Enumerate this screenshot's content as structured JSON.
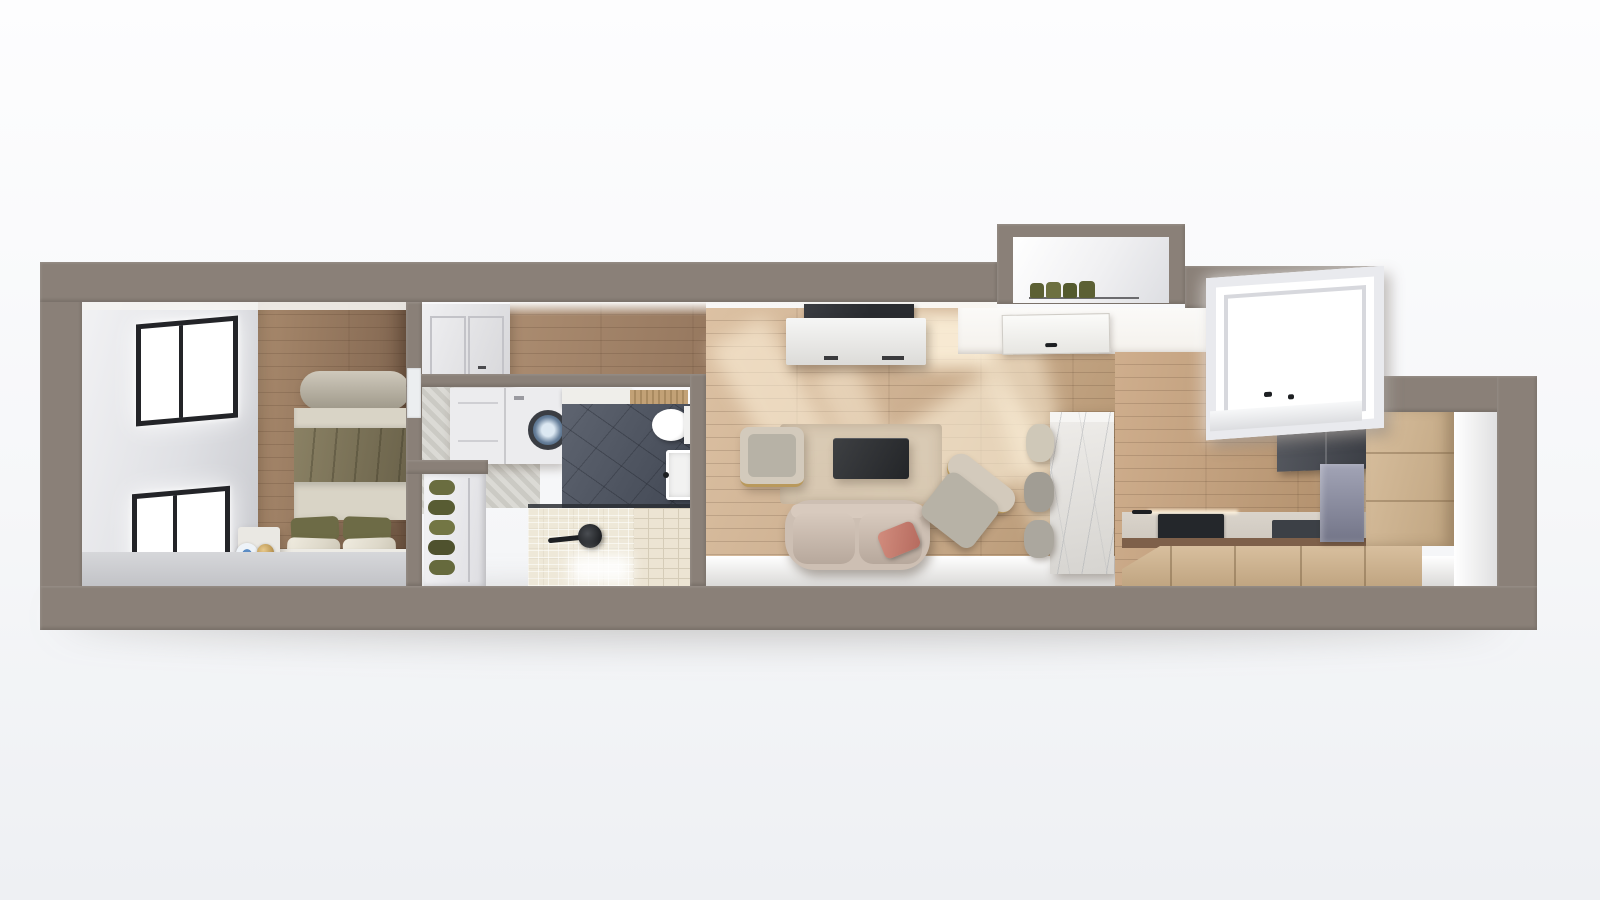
{
  "scene": {
    "label": "3d-cutaway-floor-plan-render-of-narrow-studio-apartment",
    "rooms": [
      {
        "name": "bedroom",
        "objects": [
          "window",
          "window",
          "double-bed",
          "olive-duvet",
          "pillows",
          "foot-bolster",
          "headboard-bench",
          "green-bench-cushions",
          "nightstand",
          "table-lamp",
          "decor-plate",
          "wood-floor"
        ]
      },
      {
        "name": "hallway",
        "objects": [
          "wardrobe",
          "wood-floor"
        ]
      },
      {
        "name": "bathroom",
        "objects": [
          "washer-dryer",
          "herringbone-tile",
          "patterned-dark-tile-floor",
          "toilet",
          "sink",
          "glass-shower-screen",
          "shower-head",
          "cream-tile-shower-floor",
          "towel-shelves"
        ]
      },
      {
        "name": "living-room",
        "objects": [
          "tv",
          "tv-console",
          "rug",
          "coffee-table",
          "armchair",
          "angled-armchair",
          "two-seat-sofa",
          "pink-pillow",
          "sunlight-patches",
          "wood-floor"
        ]
      },
      {
        "name": "entry",
        "objects": [
          "front-door",
          "plant-niche",
          "plants"
        ]
      },
      {
        "name": "kitchen",
        "objects": [
          "large-window",
          "marble-island",
          "bar-stools",
          "beige-base-cabinets",
          "tall-beige-cabinet",
          "dark-upper-unit",
          "marble-chimney-panel",
          "cooktop",
          "counter-sink",
          "faucet",
          "wood-floor"
        ]
      }
    ]
  },
  "palette": {
    "bg_top": "#fdfdfe",
    "bg_bottom": "#eef0f3",
    "wall": "#8a8078",
    "ceiling_white": "#f4f3f0",
    "bed_wall1": "#f2f2f4",
    "bed_wall2": "#c6c7cc",
    "wood_bed1": "#a8896c",
    "wood_bed2": "#7e634e",
    "wood_hall1": "#ab8c70",
    "wood_hall2": "#96785f",
    "wood_liv1": "#dcc1a3",
    "wood_liv2": "#b3936f",
    "wood_kit1": "#cfae8d",
    "wood_kit2": "#ac8a66",
    "sunlight": "#fff4de",
    "window_frame": "#232428",
    "glass": "#ffffff",
    "bolster1": "#cfc9bc",
    "bolster2": "#9e9889",
    "duvet1": "#8a8164",
    "duvet2": "#6a624a",
    "bed_band": "#d9d4c6",
    "pillow_dark": "#6d6b46",
    "pillow_light": "#ddd8c9",
    "bench_white": "#edebe5",
    "bench_cushion": "#575a33",
    "nightstand": "#eae8e3",
    "lamp_gold": "#bf9b58",
    "plate_blue": "#5b8cc4",
    "wardrobe1": "#f0f0f2",
    "wardrobe2": "#d7d7da",
    "washer": "#ececee",
    "washer_ring": "#3a3d43",
    "washer_glass": "#68809b",
    "chevron1": "#dbdad5",
    "chevron2": "#cbcac4",
    "slat_wood": "#c2a176",
    "dark_tile1": "#5e6470",
    "dark_tile2": "#424854",
    "cream_tile": "#ece4d3",
    "cream_grout": "#d5ccb8",
    "towel_green": "#6a6d40",
    "bath_shelf": "#efeeea",
    "glass_screen": "#2c2f35",
    "fixture_black": "#1d1f22",
    "console1": "#f6f6f5",
    "console2": "#dcdbd8",
    "tv_black": "#2a2c30",
    "rug": "#d9cab4",
    "chair_body": "#d3cabc",
    "chair_seat": "#b7b2a6",
    "gold_trim": "#b9995c",
    "table1": "#3e4043",
    "table2": "#232528",
    "sofa_body": "#cdbfb3",
    "sofa_cushion": "#b7a89c",
    "sofa_light": "#d8cabe",
    "pink1": "#d28d7e",
    "pink2": "#b56a5e",
    "marble1": "#efedea",
    "marble2": "#d6d4d0",
    "marble_vein": "#a7abb0",
    "stool1": "#cfc8b8",
    "stool2": "#a19d94",
    "stool3": "#aba79e",
    "entry_white": "#f4f1ec",
    "door_white": "#fbfbf9",
    "plant_green": "#5c6034",
    "cab_beige1": "#d8bf9e",
    "cab_beige2": "#bfa480",
    "dark_unit1": "#565960",
    "dark_unit2": "#393c43",
    "chimney1": "#a2a4b6",
    "chimney2": "#737588",
    "counter_grey": "#cfc9c0",
    "counter_edge": "#7e604a",
    "cooktop": "#24272b",
    "right_face1": "#ffffff",
    "right_face2": "#dfdfe0",
    "band1": "#ffffff",
    "band2": "#d8d7d5",
    "bedroom_band1": "#d6d7da",
    "bedroom_band2": "#c2c3c7"
  }
}
